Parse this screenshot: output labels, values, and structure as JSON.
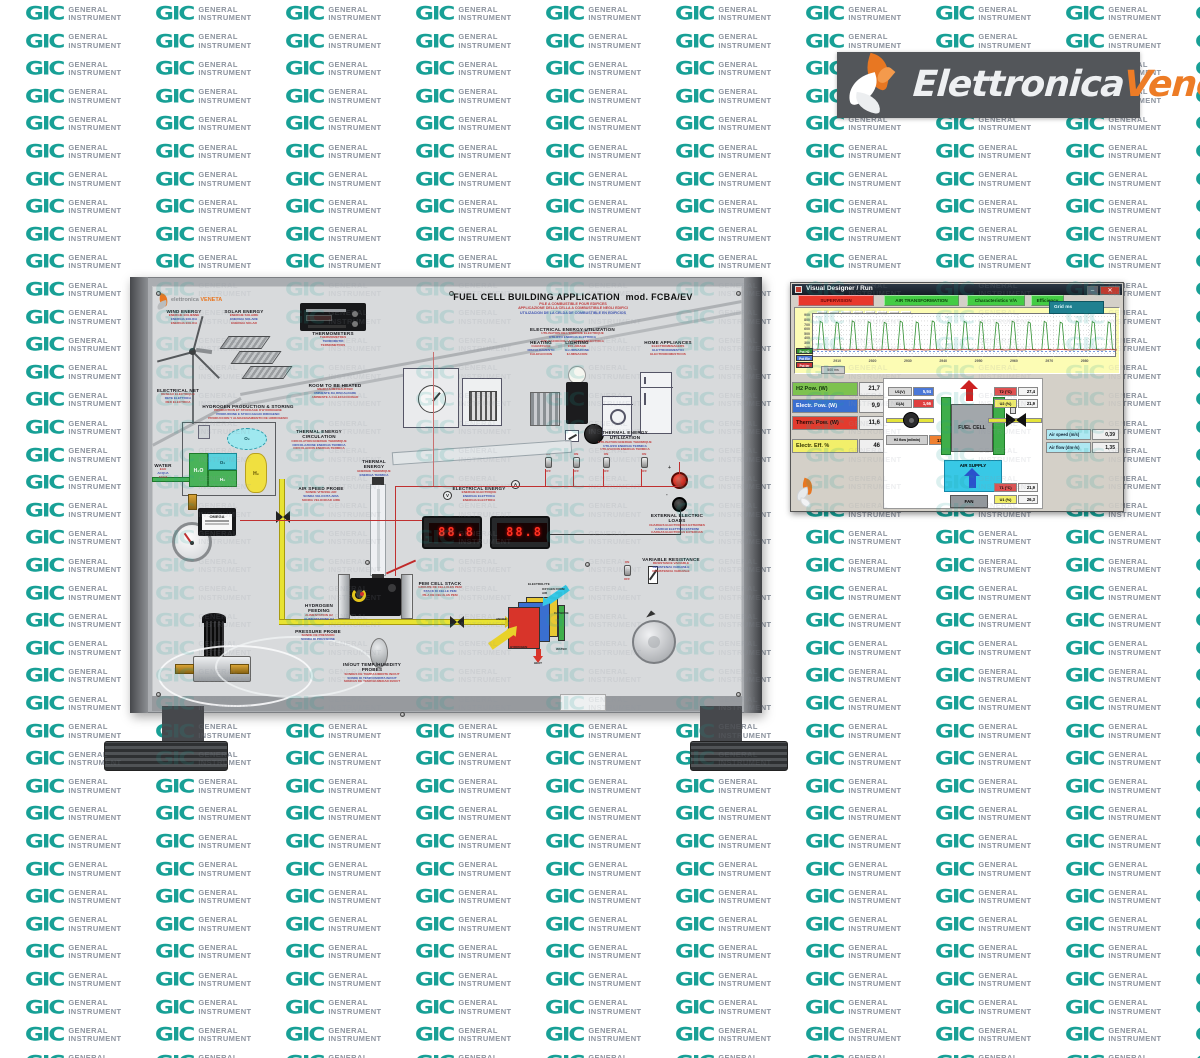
{
  "watermark": {
    "logo_text": "GIC",
    "line1": "GENERAL",
    "line2": "INSTRUMENT",
    "logo_color": "#18a096",
    "text_color": "#8e95a0"
  },
  "brand": {
    "name_part1": "Elettronica",
    "name_part2": "Veneta",
    "bar_color": "#53565a",
    "accent": "#ed7c26",
    "logo_icon": "flame-swirl-icon"
  },
  "panel": {
    "mini_logo": {
      "line1": "elettronica",
      "line2": "VENETA"
    },
    "title": {
      "main": "FUEL CELL BUILDING APPLICATION",
      "model": "mod. FCBA/EV",
      "sublines": [
        "PILE A COMBUSTIBLE POUR EDIFICES",
        "APPLICAZIONE DELLA CELLA A COMBUSTIBILE NEGLI EDIFICI",
        "UTILIZACION DE LA CELDA DE COMBUSTIBLE EN EDIFICIOS"
      ]
    },
    "labels": [
      {
        "id": "wind-energy",
        "title": "WIND ENERGY",
        "sublines": [
          "ENERGIE EOLIENNE",
          "ENERGIA EOLICA",
          "ENERGIA EOLICA"
        ]
      },
      {
        "id": "solar-energy",
        "title": "SOLAR ENERGY",
        "sublines": [
          "ENERGIE SOLAIRE",
          "ENERGIA SOLARE",
          "ENERGIA SOLAR"
        ]
      },
      {
        "id": "thermometers",
        "title": "THERMOMETERS",
        "sublines": [
          "THERMOMETRES",
          "TERMOMETRI",
          "TERMOMETROS"
        ]
      },
      {
        "id": "electrical-net",
        "title": "ELECTRICAL NET",
        "sublines": [
          "RESEAU ELECTRIQUE",
          "RETE ELETTRICA",
          "RED ELECTRICA"
        ]
      },
      {
        "id": "room-heated",
        "title": "ROOM TO BE HEATED",
        "sublines": [
          "MILIEU A RECHAUFFER",
          "AMBIENTE DA RISCALDARE",
          "AMBIENTE A CALEFACCIONAR"
        ]
      },
      {
        "id": "h2-production",
        "title": "HYDROGEN PRODUCTION & STORING",
        "sublines": [
          "PRODUCTION ET STOCKAGE D'HYDROGENE",
          "PRODUZIONE E STOCCAGGIO IDROGENO",
          "PRODUCCION Y ALMACENAMIENTO DE HIDROGENO"
        ]
      },
      {
        "id": "elec-utilization",
        "title": "ELECTRICAL ENERGY UTILIZATION",
        "sublines": [
          "UTILISATION DE L'ENERGIE ELECTRIQUE",
          "UTILIZZO ENERGIA ELETTRICA",
          "UTILIZACION DE LA ENERGIA ELECTRICA"
        ]
      },
      {
        "id": "heating",
        "title": "HEATING",
        "sublines": [
          "CHAUFFAGE",
          "RISCALDAMENTO",
          "CALEFACCION"
        ]
      },
      {
        "id": "lighting",
        "title": "LIGHTING",
        "sublines": [
          "ECLAIRAGE",
          "ILLUMINAZIONE",
          "ILUMINACION"
        ]
      },
      {
        "id": "home-appliances",
        "title": "HOME APPLIANCES",
        "sublines": [
          "ELECTROMENAGERS",
          "ELETTRODOMESTICI",
          "ELECTRODOMESTICOS"
        ]
      },
      {
        "id": "thermal-circ",
        "title": "THERMAL ENERGY CIRCULATION",
        "sublines": [
          "CIRCULATION ENERGIE THERMIQUE",
          "CIRCOLAZIONE ENERGIA TERMICA",
          "CIRCULACION ENERGIA TERMICA"
        ]
      },
      {
        "id": "thermal-util",
        "title": "THERMAL ENERGY UTILIZATION",
        "sublines": [
          "UTILISATION ENERGIE THERMIQUE",
          "UTILIZZO ENERGIA TERMICA",
          "UTILIZACION ENERGIA TERMICA"
        ]
      },
      {
        "id": "thermal-energy",
        "title": "THERMAL ENERGY",
        "sublines": [
          "ENERGIE THERMIQUE",
          "ENERGIA TERMICA"
        ]
      },
      {
        "id": "air-speed-probe",
        "title": "AIR SPEED PROBE",
        "sublines": [
          "SONDE VITESSE AIR",
          "SONDA VELOCITA ARIA",
          "SONDA VELOCIDAD AIRE"
        ]
      },
      {
        "id": "electrical-energy",
        "title": "ELECTRICAL ENERGY",
        "sublines": [
          "ENERGIE ELECTRIQUE",
          "ENERGIA ELETTRICA",
          "ENERGIA ELECTRICA"
        ]
      },
      {
        "id": "external-load",
        "title": "EXTERNAL ELECTRIC LOADS",
        "sublines": [
          "CHARGES ELECTRIQUES EXTERNES",
          "CARICHI ELETTRICI ESTERNI",
          "CARGAS ELECTRICAS EXTERNAS"
        ]
      },
      {
        "id": "variable-resistance",
        "title": "VARIABLE RESISTANCE",
        "sublines": [
          "RESISTANCE VARIABLE",
          "RESISTENZA VARIABILE",
          "RESISTENCIA VARIABLE"
        ]
      },
      {
        "id": "pem-stack",
        "title": "PEM CELL STACK",
        "sublines": [
          "GROUPE DE CELLULES PEM",
          "STACK DI CELLE PEM",
          "PILA DE CELULAS PEM"
        ]
      },
      {
        "id": "probes",
        "title": "IN/OUT TEMP./HUMIDITY PROBES",
        "sublines": [
          "SONDES DE TEMP./HUMIDITE IN/OUT",
          "SONDE DI TEMP./UMIDITA IN/OUT",
          "SONDAS DE TEMP./HUMEDAD IN/OUT"
        ]
      },
      {
        "id": "water",
        "title": "WATER",
        "sublines": [
          "EAU",
          "ACQUA",
          "AGUA"
        ]
      },
      {
        "id": "h2-feeding",
        "title": "HYDROGEN FEEDING",
        "sublines": [
          "ALIMENTATION H2",
          "ALIMENTAZIONE H2"
        ]
      },
      {
        "id": "pressure-probe",
        "title": "PRESSURE PROBE",
        "sublines": [
          "SONDE DE PRESSION",
          "SONDA DI PRESSIONE"
        ]
      }
    ],
    "electrolyzer": {
      "h2o": "H₂O",
      "o2": "O₂",
      "h2": "H₂"
    },
    "flowmeter_brand": "OMEGA",
    "meters": {
      "volt_symbol": "V",
      "amp_symbol": "A",
      "volt_display": "88.8",
      "amp_display": "88.8"
    },
    "switch_on": "ON",
    "switch_off": "OFF",
    "jack_plus": "+",
    "jack_minus": "-",
    "celldiagram": {
      "electrolyte": "ELECTROLYTE",
      "oxygen": "OXYGEN FROM AIR",
      "cathode": "CATHODE",
      "anode": "ANODE",
      "hydrogen": "HYDROGEN",
      "water": "WATER",
      "heat": "HEAT"
    }
  },
  "software": {
    "window_title": "Visual Designer / Run",
    "window_buttons": {
      "minimize": "–",
      "close": "✕"
    },
    "tabs": [
      {
        "label": "SUPERVISION",
        "style": "red"
      },
      {
        "label": "AIR TRANSFORMATION",
        "style": "green"
      },
      {
        "label": "Characteristics V/A",
        "style": "green"
      },
      {
        "label": "Efficiency",
        "style": "green"
      }
    ],
    "grid_box_label": "Grid ms",
    "time_button_label": "500 ms",
    "toolbar_icons": [
      "open-icon",
      "save-icon",
      "print-icon",
      "copy-icon",
      "palette-icon",
      "zoom-icon",
      "pause-icon",
      "grid-icon"
    ],
    "readings_left": [
      {
        "label": "H2 Pow. (W)",
        "value": "21,7",
        "bg": "#7dc24f",
        "fg": "#11320a"
      },
      {
        "label": "Electr. Pow. (W)",
        "value": "9,9",
        "bg": "#3a6fd0",
        "fg": "#ffffff"
      },
      {
        "label": "Therm. Pow. (W)",
        "value": "11,6",
        "bg": "#e23b2e",
        "fg": "#2b0603"
      },
      {
        "label": "Electr. Eff. %",
        "value": "46",
        "bg": "#f2ef6a",
        "fg": "#333300"
      }
    ],
    "diagram": {
      "u1v_label": "U1(V)",
      "u1v_value": "5,94",
      "i1a_label": "I1(A)",
      "i1a_value": "1,66",
      "h2flow_label": "H2 flow (ml/min)",
      "h2flow_value": "132",
      "fuel_cell_label": "FUEL CELL",
      "air_supply_label": "AIR SUPPLY",
      "fan_label": "FAN",
      "t2_label": "T2 (°C)",
      "t2_value": "27,4",
      "u2_label": "U2 (%)",
      "u2_value": "21,9",
      "t1_label": "T1 (°C)",
      "t1_value": "21,9",
      "u1p_label": "U1 (%)",
      "u1p_value": "26,3"
    },
    "readings_right": [
      {
        "label": "Air speed (m/s)",
        "value": "0,39"
      },
      {
        "label": "Air flow (dm³/s)",
        "value": "1,35"
      }
    ]
  },
  "chart_data": {
    "type": "line",
    "title": "",
    "x_range": [
      2902,
      2988
    ],
    "x_ticks": [
      2910,
      2920,
      2930,
      2940,
      2950,
      2960,
      2970,
      2980
    ],
    "y_range": [
      0,
      950
    ],
    "y_ticks": [
      100,
      200,
      300,
      400,
      500,
      600,
      700,
      800,
      900
    ],
    "grid": true,
    "legend_position": "left",
    "background": "#fcfcb4",
    "series": [
      {
        "name": "Pot H2",
        "color": "#2f8f2f",
        "type": "spikes",
        "baseline": 175,
        "peaks": [
          790,
          775,
          800,
          785,
          770,
          795,
          780,
          800,
          775,
          790,
          785,
          770,
          795,
          780,
          790,
          775,
          800,
          785,
          780
        ]
      },
      {
        "name": "Pot Ele",
        "color": "#4b78d8",
        "type": "flat",
        "value": 140,
        "dashed": true
      },
      {
        "name": "Pot ter",
        "color": "#cc3333",
        "type": "flat",
        "value": 178,
        "dashed": false
      }
    ]
  }
}
